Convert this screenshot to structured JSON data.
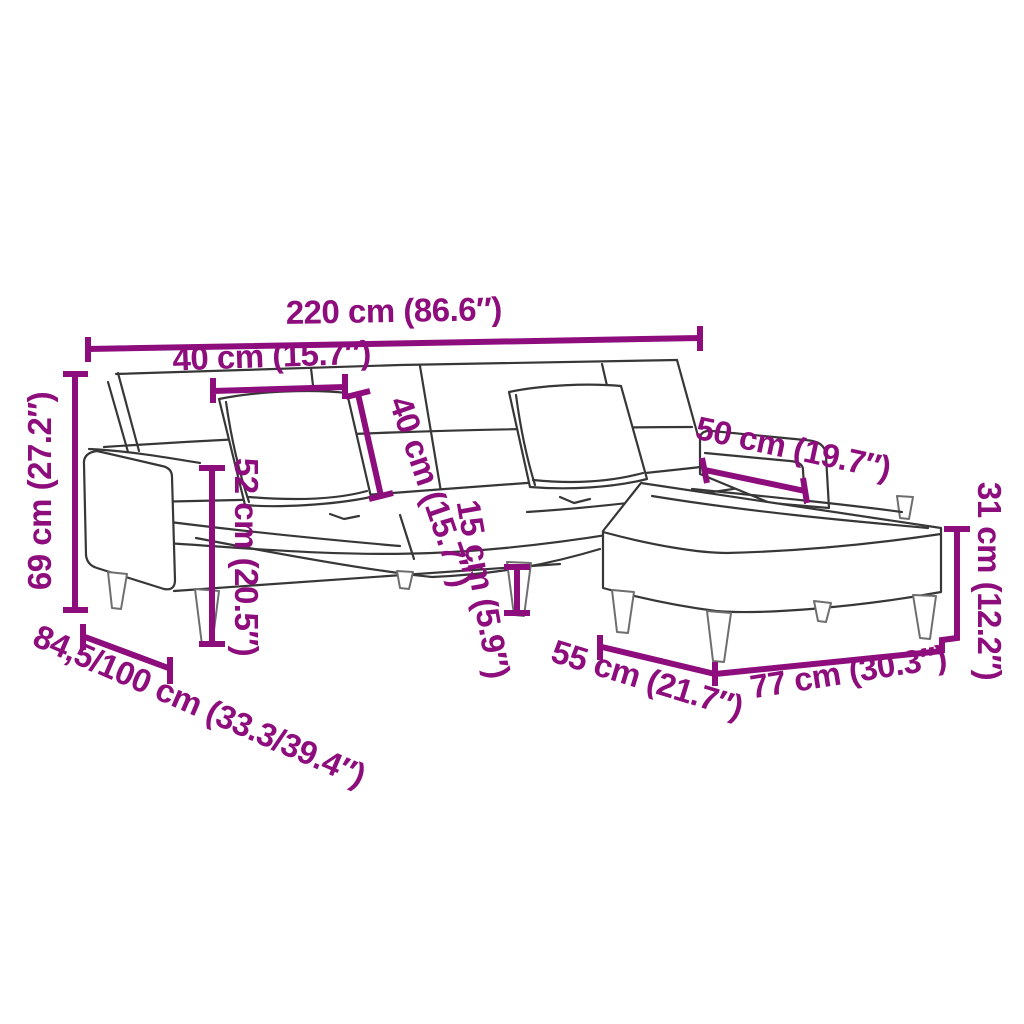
{
  "diagram": {
    "subject": "sofa bed with two pillows and footstool",
    "background_color": "#ffffff",
    "outline_color": "#373737",
    "dimension_color": "#8E0D7D"
  },
  "dims": {
    "overall_width": {
      "label": "220 cm (86.6″)"
    },
    "pillow_width": {
      "label": "40 cm (15.7″)"
    },
    "pillow_height": {
      "label": "40 cm (15.7″)"
    },
    "overall_height": {
      "label": "69 cm (27.2″)"
    },
    "seat_back_height": {
      "label": "52 cm (20.5″)"
    },
    "leg_height": {
      "label": "15 cm (5.9″)"
    },
    "armrest_depth": {
      "label": "50 cm (19.7″)"
    },
    "footstool_height": {
      "label": "31 cm (12.2″)"
    },
    "overall_depth": {
      "label": "84,5/100 cm (33.3/39.4″)"
    },
    "footstool_depth": {
      "label": "55 cm (21.7″)"
    },
    "footstool_width": {
      "label": "77 cm (30.3″)"
    }
  }
}
